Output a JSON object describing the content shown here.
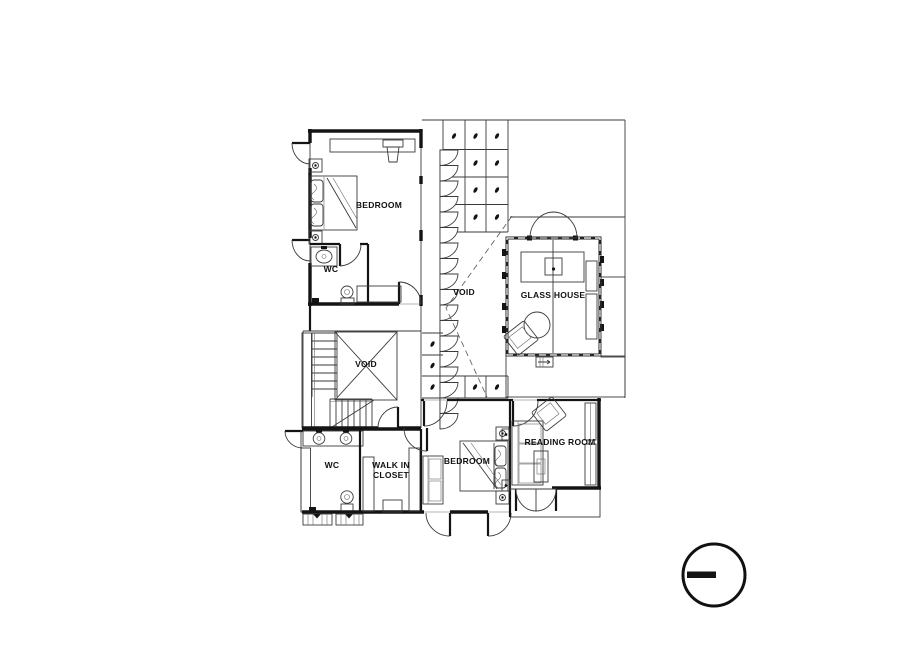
{
  "page": {
    "background": "#ffffff",
    "type": "architectural-floor-plan"
  },
  "plan": {
    "labels": {
      "bedroom_upper": "BEDROOM",
      "wc_upper": "WC",
      "void_stair": "VOID",
      "void_court": "VOID",
      "glass_house": "GLASS HOUSE",
      "reading_room": "READING ROOM",
      "wc_lower": "WC",
      "walk_in_closet_line1": "WALK IN",
      "walk_in_closet_line2": "CLOSET",
      "bedroom_lower": "BEDROOM"
    },
    "colors": {
      "ink": "#141414",
      "ink_light": "#555555",
      "background": "#ffffff"
    }
  },
  "symbols": {
    "section_marker": "circle-with-horizontal-bar"
  }
}
